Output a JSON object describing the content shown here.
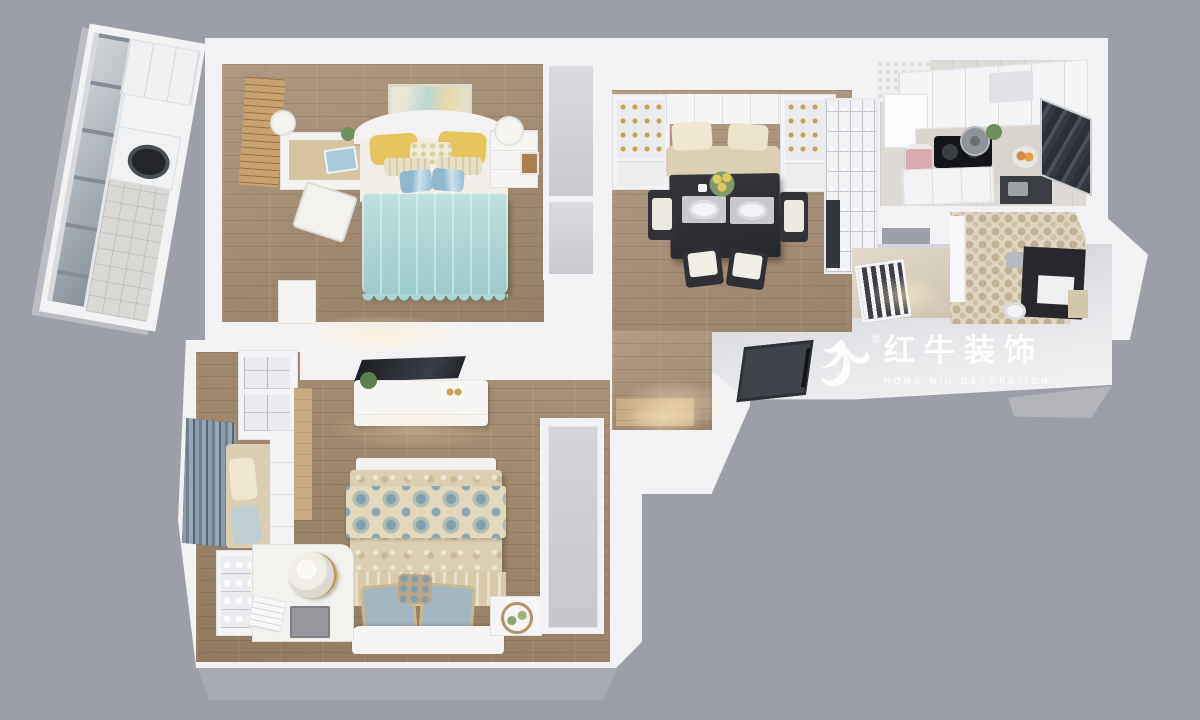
{
  "scene": {
    "type": "3d-floorplan-render",
    "background_color": "#9c9ea8",
    "wall_color": "#f2f2f4",
    "wall_side_color": "#aaabb2"
  },
  "watermark": {
    "icon": "bull-swoosh-icon",
    "registered_mark": "®",
    "title_cn": "红牛装饰",
    "subtitle_en": "HONG NIU DECORATION",
    "color": "#ffffff"
  },
  "palette": {
    "floor_wood": "#a68d72",
    "floor_wood_dark": "#a1886b",
    "floor_wood_lit": "#c6ab83",
    "blanket_teal": "#a9d6d6",
    "pillow_yellow": "#e7c55e",
    "pillow_blue": "#8fb8cf",
    "quilt_beige": "#ddcfb2",
    "damask_blue": "#7fa0ae",
    "curtain_blue": "#8a9cab",
    "dining_table_dark": "#2e3035",
    "cooktop_dark": "#17181c",
    "bathroom_tile": "#e0d5c1",
    "cushion_beige": "#dccfb4",
    "rice_cooker_pink": "#d9abb0"
  },
  "rooms": [
    {
      "name": "balcony",
      "items": [
        "window-wall",
        "overhead-cabinet",
        "washing-machine",
        "tile-floor"
      ]
    },
    {
      "name": "bedroom-1",
      "items": [
        "wall-art",
        "louver-shutter",
        "desk",
        "desk-chair",
        "double-bed",
        "teal-blanket",
        "yellow-pillows",
        "nightstand",
        "wardrobe"
      ]
    },
    {
      "name": "living-dining",
      "items": [
        "glass-cabinets",
        "banquette",
        "dining-table",
        "place-settings",
        "flower-centerpiece",
        "chairs",
        "display-shelf"
      ]
    },
    {
      "name": "kitchen",
      "items": [
        "upper-cabinets",
        "fridge",
        "cooktop",
        "pot",
        "rice-cooker",
        "fruit-bowl",
        "base-cabinets",
        "glass-partition"
      ]
    },
    {
      "name": "hallway",
      "items": [
        "railing"
      ]
    },
    {
      "name": "bathroom",
      "items": [
        "door",
        "shower-fixture",
        "vanity",
        "sink",
        "toilet"
      ]
    },
    {
      "name": "entry",
      "items": [
        "entry-door"
      ]
    },
    {
      "name": "bedroom-2",
      "items": [
        "tv",
        "tv-cabinet",
        "bench",
        "damask-quilt-bed",
        "blue-pillows",
        "nightstand-wreath",
        "overhead-cabinets",
        "curtains",
        "window-seat",
        "shelf",
        "china-cabinet",
        "vanity-desk",
        "jug",
        "laptop",
        "wardrobe"
      ]
    }
  ]
}
